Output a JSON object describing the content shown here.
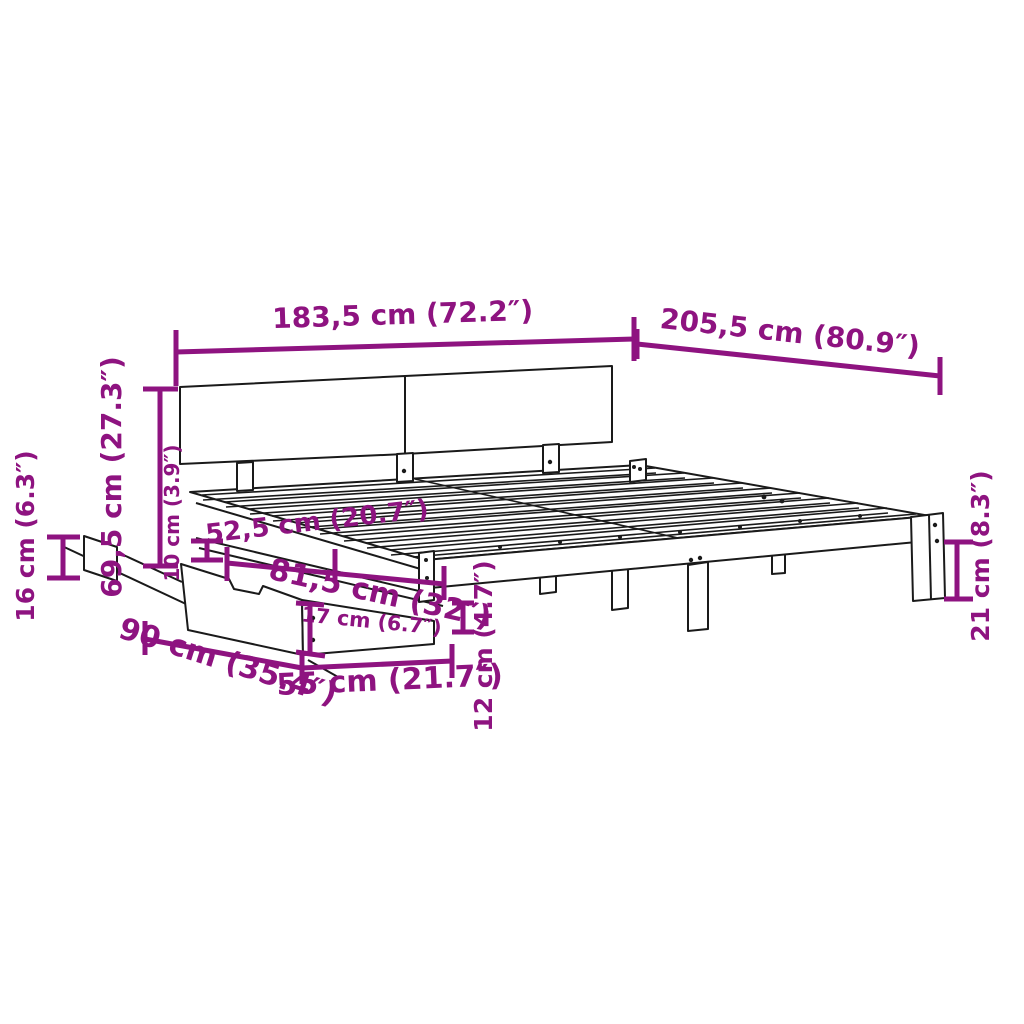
{
  "page": {
    "title": "Bed frame with under-bed storage drawer - dimension diagram",
    "background": "#ffffff"
  },
  "colors": {
    "dimension_accent": "#8E1380",
    "line_art": "#1a1a1a"
  },
  "labels": {
    "headboard_width": "183,5 cm (72.2″)",
    "frame_length": "205,5 cm (80.9″)",
    "headboard_height": "69,5 cm (27.3″)",
    "left_rail_height": "16 cm (6.3″)",
    "side_rail_height": "10 cm (3.9″)",
    "pullout_depth": "52,5 cm (20.7″)",
    "drawer_width": "81,5 cm (32″)",
    "drawer_front_height": "17 cm (6.7″)",
    "drawer_depth": "90 cm (35.4″)",
    "drawer_front_width": "55 cm (21.7″)",
    "frame_front_height": "12 cm (4.7″)",
    "leg_height": "21 cm (8.3″)"
  }
}
